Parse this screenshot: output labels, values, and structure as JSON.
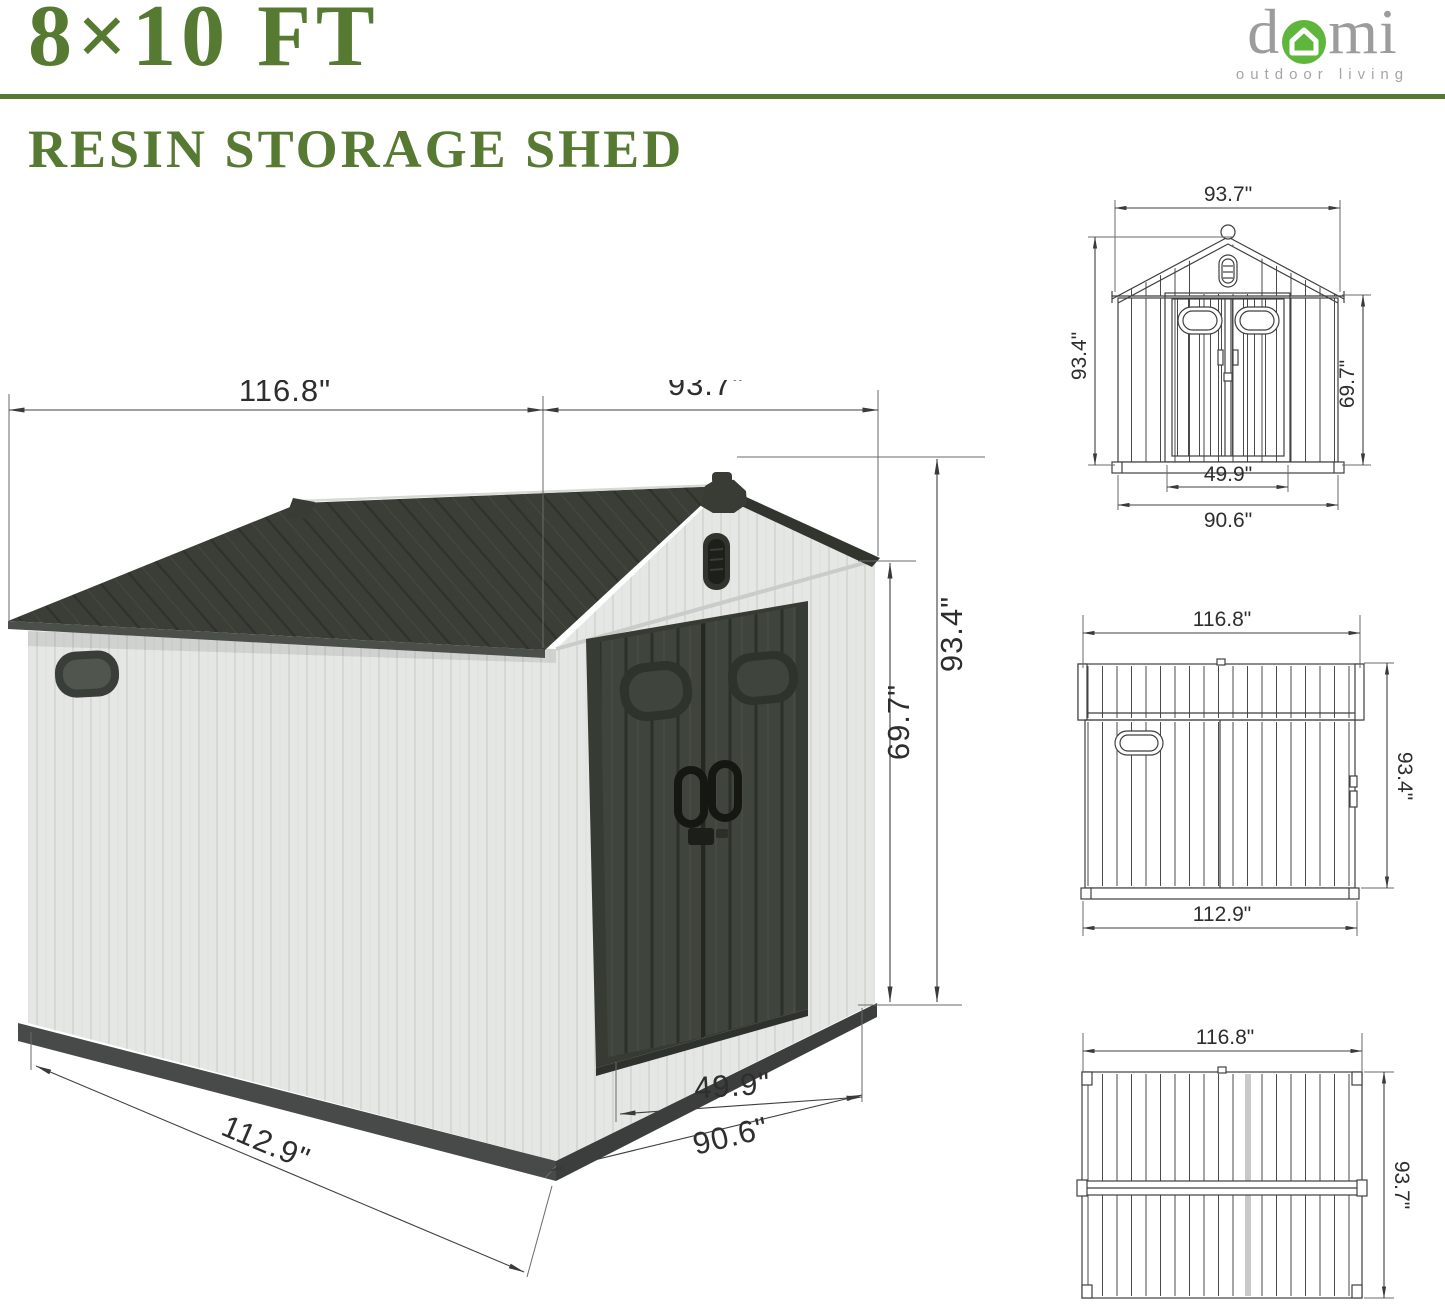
{
  "header": {
    "size_title": "8×10 FT",
    "subtitle": "RESIN STORAGE SHED",
    "logo": {
      "text_d": "d",
      "text_mi": "mi",
      "tagline": "outdoor living"
    }
  },
  "colors": {
    "heading_green": "#567a31",
    "rule_green": "#567a31",
    "logo_gray": "#9c9c9c",
    "logo_green": "#5eb73c",
    "roof_dark": "#3a3e36",
    "door_dark": "#3f443c",
    "wall_light": "#e5e7e4",
    "base_dark": "#474a48",
    "dimension_line": "#3f3f3f"
  },
  "perspective_view": {
    "dim_total_width": "116.8\"",
    "dim_total_depth": "93.7\"",
    "dim_total_height": "93.4\"",
    "dim_wall_height": "69.7\"",
    "dim_door_width": "49.9\"",
    "dim_front_width": "90.6\"",
    "dim_side_width": "112.9\""
  },
  "front_view": {
    "dim_width": "93.7\"",
    "dim_height": "93.4\"",
    "dim_wall_height": "69.7\"",
    "dim_door_width": "49.9\"",
    "dim_body_width": "90.6\""
  },
  "side_view": {
    "dim_width": "116.8\"",
    "dim_height": "93.4\"",
    "dim_body_width": "112.9\""
  },
  "plan_view": {
    "dim_length": "116.8\"",
    "dim_depth": "93.7\""
  }
}
